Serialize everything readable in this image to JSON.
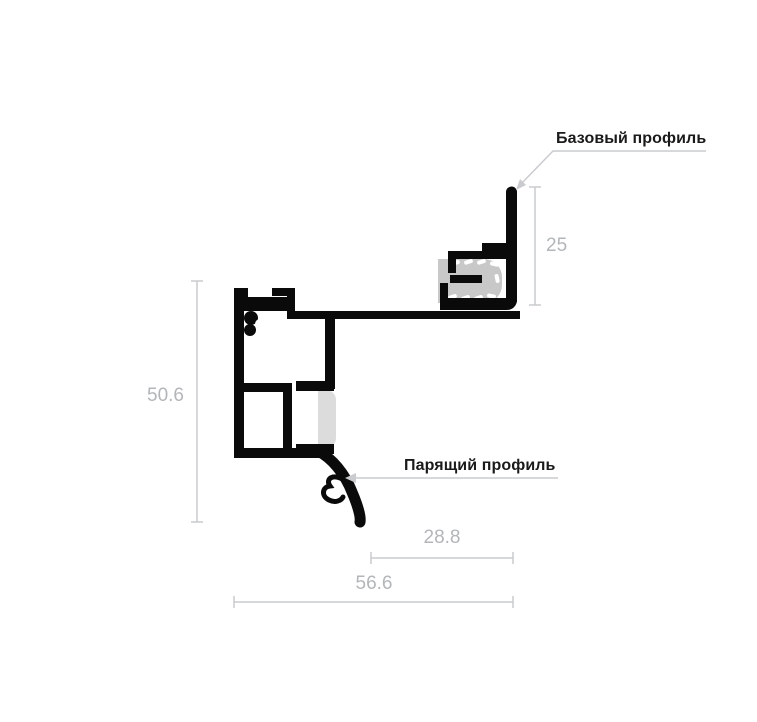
{
  "diagram": {
    "labels": {
      "base_profile": "Базовый профиль",
      "floating_profile": "Парящий профиль"
    },
    "dimensions": {
      "base_profile_height": "25",
      "overall_height": "50.6",
      "hook_offset_width": "28.8",
      "overall_width": "56.6"
    },
    "colors": {
      "profile_black": "#0a0a0a",
      "dimension_gray": "#c9cbce",
      "dimension_text_gray": "#b3b6b9",
      "gasket_gray": "#c8c8c8",
      "clip_gray": "#dcdcdc",
      "label_text": "#1a1a1a",
      "background": "#ffffff"
    }
  }
}
